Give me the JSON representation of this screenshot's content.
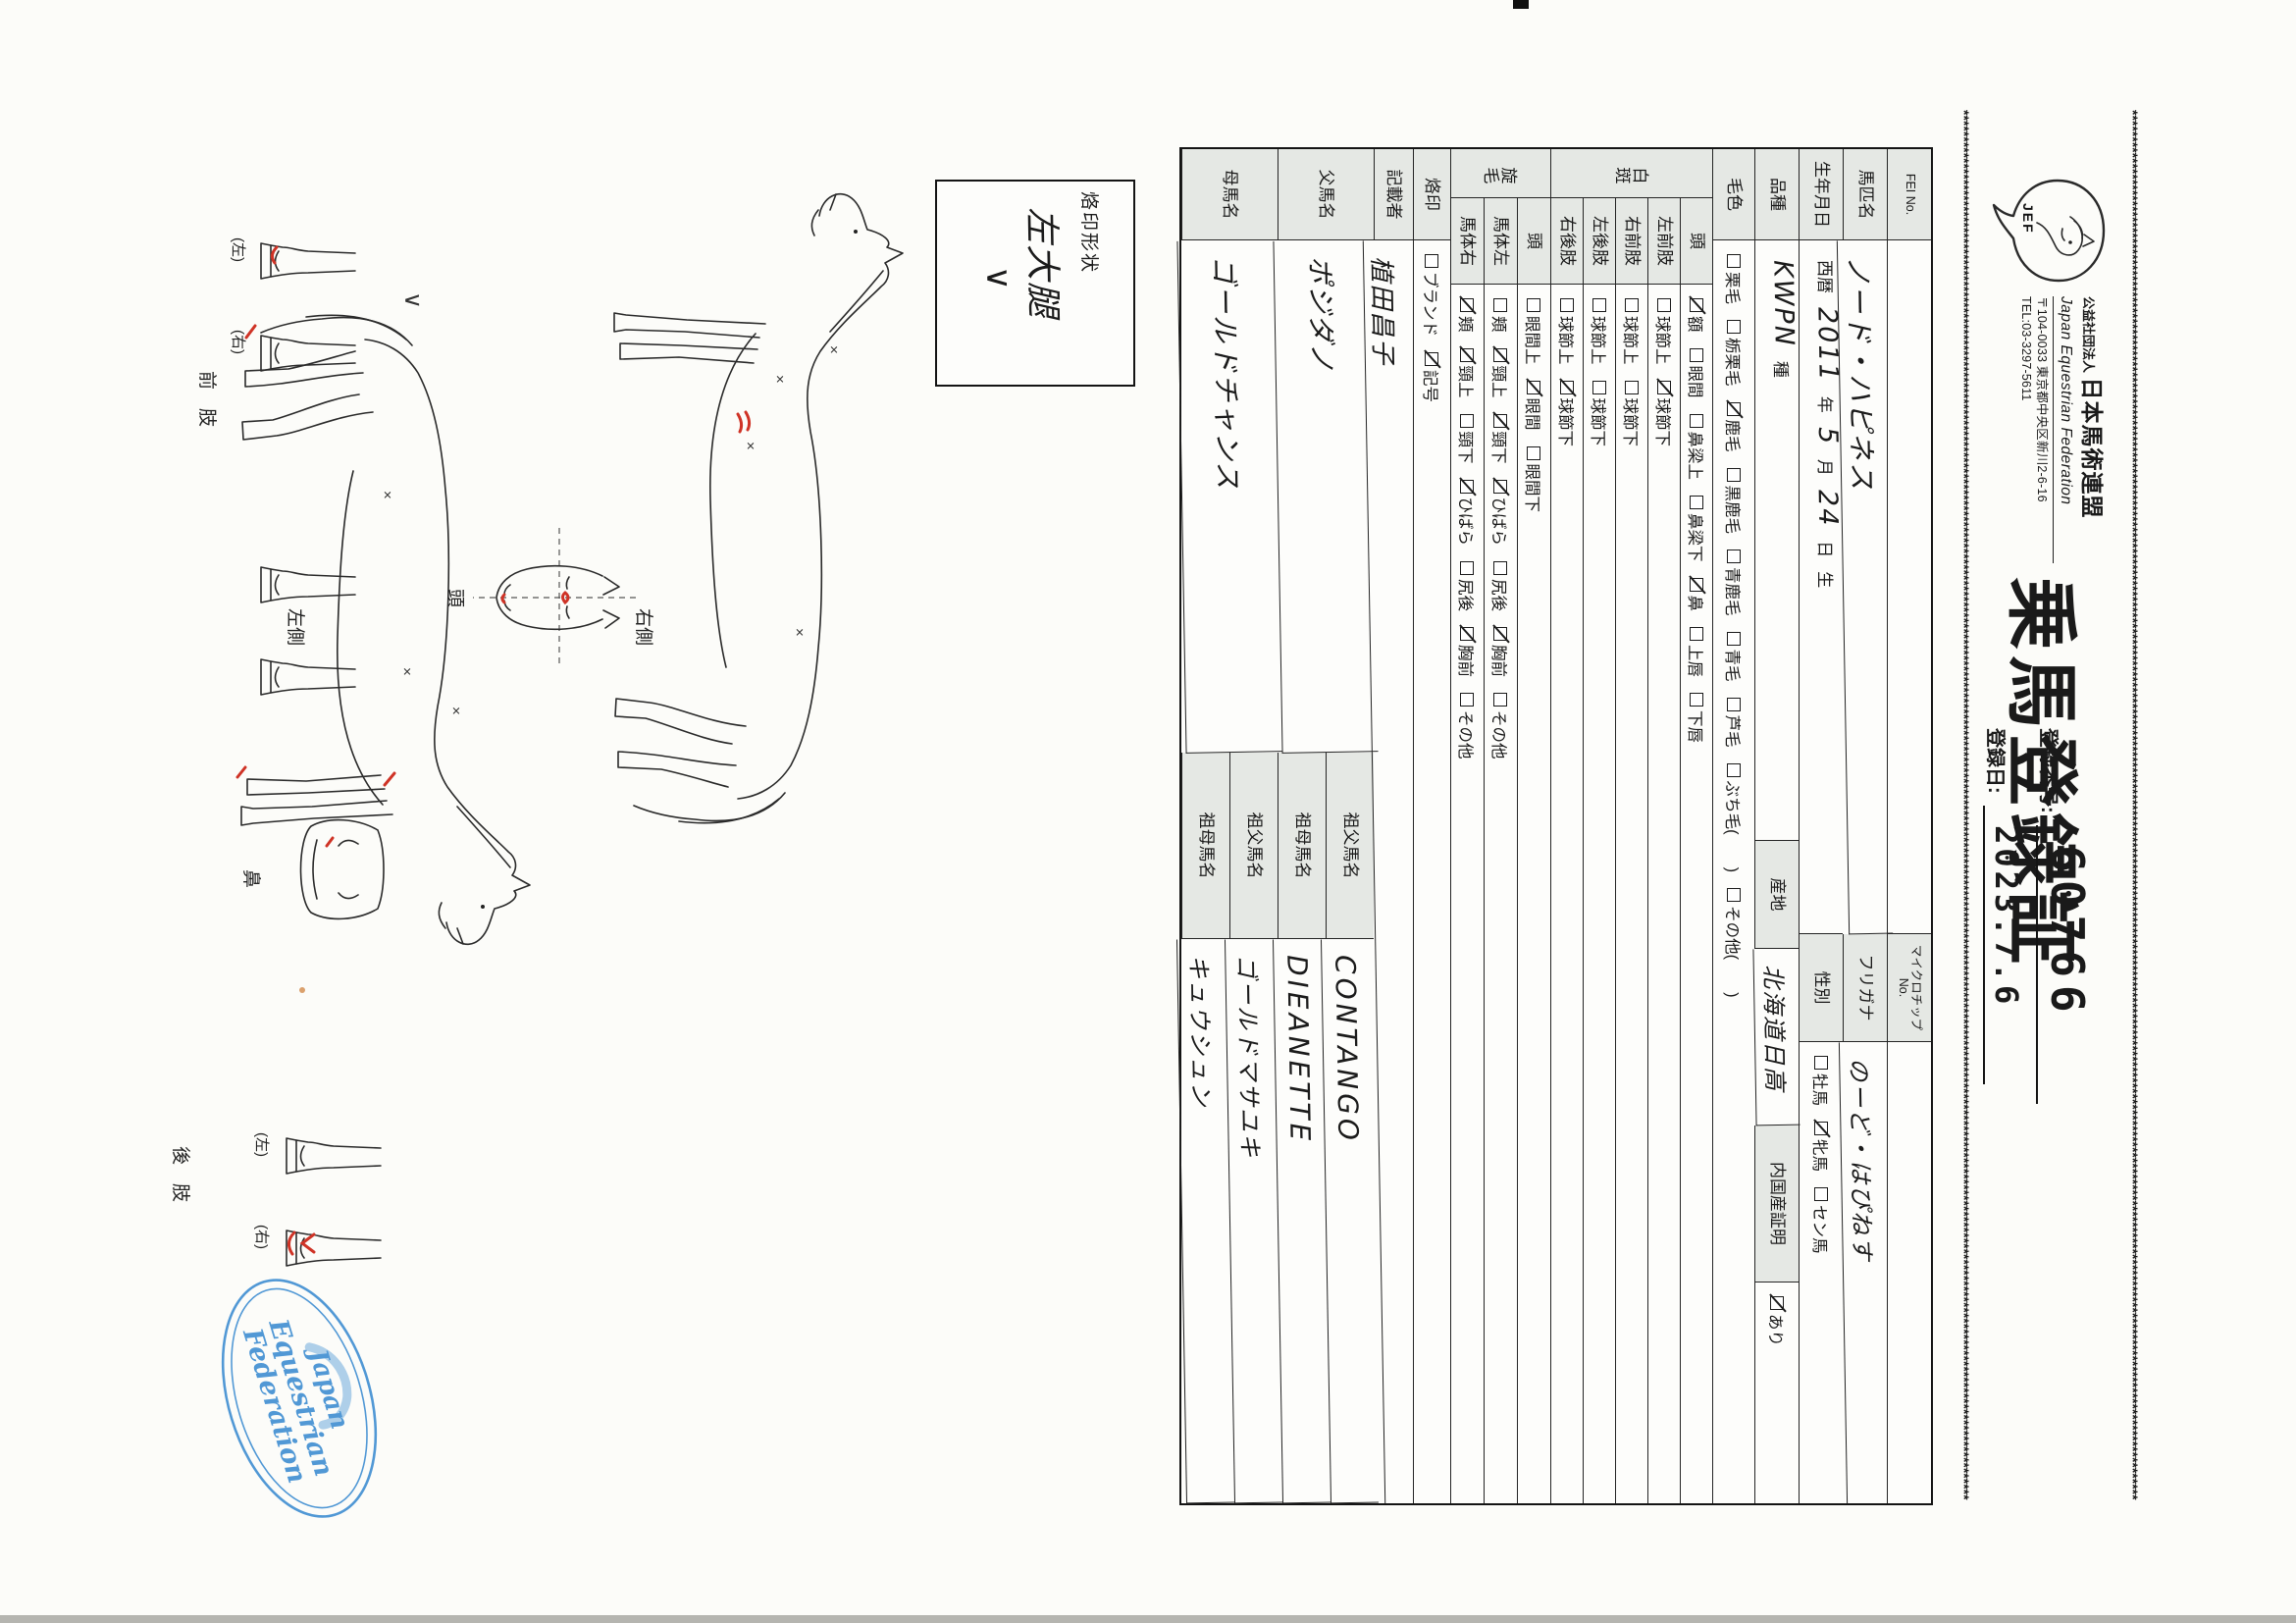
{
  "header": {
    "org_prefix": "公益社団法人",
    "org_name": "日本馬術連盟",
    "org_name_en": "Japan Equestrian Federation",
    "address": "〒104-0033 東京都中央区新川2-6-16",
    "tel": "TEL:03-3297-5611",
    "logo_text": "JEF",
    "title": "乗馬登録証",
    "reg_no_label": "登録番号:",
    "reg_no": "60766",
    "reg_date_label": "登録日:",
    "reg_date": "2023.7.6",
    "border_char": "*"
  },
  "table": {
    "rows": [
      {
        "type": "split",
        "label": "FEI No.",
        "value": "",
        "label2": "マイクロチップNo.",
        "small2": true,
        "value2": "",
        "h": 45
      },
      {
        "type": "split",
        "label": "馬匹名",
        "value": "ノード・ハピネス",
        "value_hw": true,
        "label2": "フリガナ",
        "value2": "のーど・はぴねす",
        "value2_hw": true,
        "h": 45
      },
      {
        "type": "birth",
        "label": "生年月日",
        "parts": [
          {
            "t": "西暦"
          },
          {
            "t": "2011",
            "hw": true
          },
          {
            "t": "年"
          },
          {
            "t": "5",
            "hw": true
          },
          {
            "t": "月"
          },
          {
            "t": "24",
            "hw": true
          },
          {
            "t": "日"
          },
          {
            "t": "生"
          }
        ],
        "label2": "性別",
        "options2": [
          {
            "t": "牡馬",
            "c": false
          },
          {
            "t": "牝馬",
            "c": true
          },
          {
            "t": "セン馬",
            "c": false
          }
        ],
        "h": 45
      },
      {
        "type": "breed",
        "label": "品種",
        "parts": [
          {
            "t": "KWPN",
            "hw": true
          },
          {
            "t": "種"
          }
        ],
        "label2": "産地",
        "value2": "北海道日高",
        "label3": "内国産証明",
        "options3": [
          {
            "t": "あり",
            "c": true
          }
        ],
        "h": 45
      },
      {
        "type": "opts",
        "label": "毛色",
        "options": [
          {
            "t": "栗毛",
            "c": false
          },
          {
            "t": "栃栗毛",
            "c": false
          },
          {
            "t": "鹿毛",
            "c": true
          },
          {
            "t": "黒鹿毛",
            "c": false
          },
          {
            "t": "青鹿毛",
            "c": false
          },
          {
            "t": "青毛",
            "c": false
          },
          {
            "t": "芦毛",
            "c": false
          },
          {
            "t": "ぶち毛(　　)",
            "c": false
          },
          {
            "t": "その他(　　)",
            "c": false
          }
        ],
        "h": 43
      },
      {
        "type": "group",
        "label": "白斑",
        "rh": 33,
        "subrows": [
          {
            "sub": "頭",
            "options": [
              {
                "t": "額",
                "c": true
              },
              {
                "t": "眼間",
                "c": false
              },
              {
                "t": "鼻梁上",
                "c": false
              },
              {
                "t": "鼻梁下",
                "c": false
              },
              {
                "t": "鼻",
                "c": true
              },
              {
                "t": "上唇",
                "c": false
              },
              {
                "t": "下唇",
                "c": false
              }
            ]
          },
          {
            "sub": "左前肢",
            "options": [
              {
                "t": "球節上",
                "c": false
              },
              {
                "t": "球節下",
                "c": true
              }
            ]
          },
          {
            "sub": "右前肢",
            "options": [
              {
                "t": "球節上",
                "c": false
              },
              {
                "t": "球節下",
                "c": false
              }
            ]
          },
          {
            "sub": "左後肢",
            "options": [
              {
                "t": "球節上",
                "c": false
              },
              {
                "t": "球節下",
                "c": false
              }
            ]
          },
          {
            "sub": "右後肢",
            "options": [
              {
                "t": "球節上",
                "c": false
              },
              {
                "t": "球節下",
                "c": true
              }
            ]
          }
        ]
      },
      {
        "type": "group",
        "label": "旋毛",
        "rh": 34,
        "subrows": [
          {
            "sub": "頭",
            "options": [
              {
                "t": "眼間上",
                "c": false
              },
              {
                "t": "眼間",
                "c": true
              },
              {
                "t": "眼間下",
                "c": false
              }
            ]
          },
          {
            "sub": "馬体左",
            "options": [
              {
                "t": "頬",
                "c": false
              },
              {
                "t": "頸上",
                "c": true
              },
              {
                "t": "頸下",
                "c": true
              },
              {
                "t": "ひばら",
                "c": true
              },
              {
                "t": "尻後",
                "c": false
              },
              {
                "t": "胸前",
                "c": true
              },
              {
                "t": "その他",
                "c": false
              }
            ]
          },
          {
            "sub": "馬体右",
            "options": [
              {
                "t": "頬",
                "c": true
              },
              {
                "t": "頸上",
                "c": true
              },
              {
                "t": "頸下",
                "c": false
              },
              {
                "t": "ひばら",
                "c": true
              },
              {
                "t": "尻後",
                "c": false
              },
              {
                "t": "胸前",
                "c": true
              },
              {
                "t": "その他",
                "c": false
              }
            ]
          }
        ]
      },
      {
        "type": "opts",
        "label": "烙印",
        "options": [
          {
            "t": "ブランド",
            "c": false
          },
          {
            "t": "記号",
            "c": true
          }
        ],
        "h": 38
      },
      {
        "type": "hwrow",
        "label": "記載者",
        "value": "植田昌子",
        "h": 40
      }
    ],
    "pedigree": {
      "sire_label": "父馬名",
      "sire": "ポジダノ",
      "dam_label": "母馬名",
      "dam": "ゴールドチャンス",
      "gsire_label": "祖父馬名",
      "gdam_label": "祖母馬名",
      "sire_gsire": "CONTANGO",
      "sire_gdam": "DIEANETTE",
      "dam_gsire": "ゴールドマサユキ",
      "dam_gdam": "キュウシュン"
    }
  },
  "brand_box": {
    "label": "烙印形状",
    "value_line1": "左大腿",
    "value_line2": "∨"
  },
  "diagram": {
    "right_side_label": "右側",
    "left_side_label": "左側",
    "head_label": "頭",
    "nose_label": "鼻",
    "front_leg_label": "前　肢",
    "hind_leg_label": "後　肢",
    "left_paren": "(左)",
    "right_paren": "(右)",
    "thigh_brand": "∨"
  },
  "stamp": {
    "word1": "Japan",
    "word2": "Equestrian",
    "word3": "Federation",
    "color": "#3f8ed2"
  }
}
